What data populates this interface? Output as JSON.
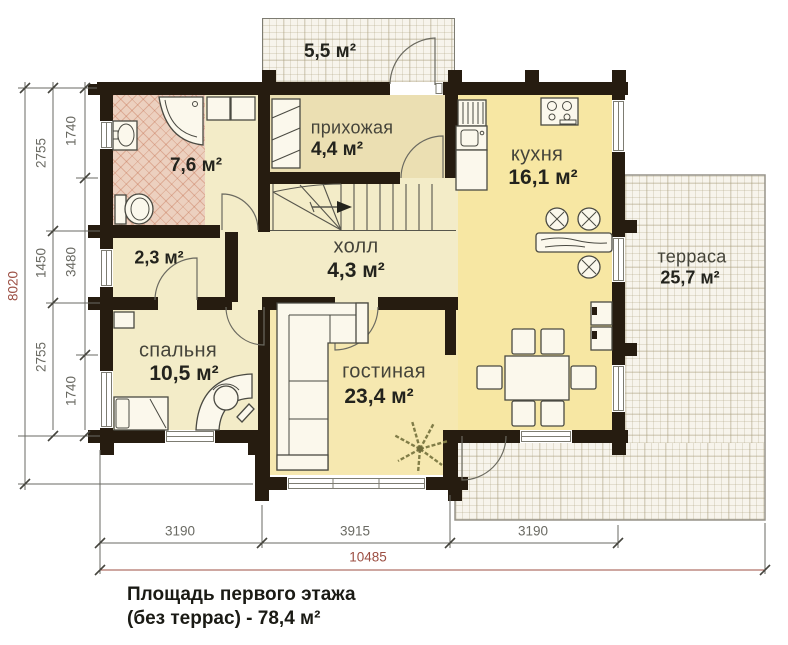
{
  "rooms": {
    "porch": {
      "area": "5,5 м²"
    },
    "bathroom": {
      "area": "7,6 м²"
    },
    "hallway": {
      "name": "прихожая",
      "area": "4,4 м²"
    },
    "kitchen": {
      "name": "кухня",
      "area": "16,1 м²"
    },
    "hall": {
      "name": "холл",
      "area": "4,3 м²"
    },
    "closet": {
      "area": "2,3 м²"
    },
    "bedroom": {
      "name": "спальня",
      "area": "10,5 м²"
    },
    "living": {
      "name": "гостиная",
      "area": "23,4 м²"
    },
    "terrace": {
      "name": "терраса",
      "area": "25,7 м²"
    }
  },
  "dimensions": {
    "left": {
      "overall": "8020",
      "inner": [
        "2755",
        "1450",
        "2755"
      ],
      "innermost": [
        "1740",
        "3480",
        "1740"
      ]
    },
    "bottom": {
      "segments": [
        "3190",
        "3915",
        "3190"
      ],
      "overall": "10485"
    }
  },
  "caption": {
    "line1": "Площадь первого этажа",
    "line2": "(без террас) - 78,4 м²"
  },
  "colors": {
    "wall": "#261c10",
    "cream": "#f3ecc8",
    "tan": "#ebdfb2",
    "yellow": "#f7e7a3",
    "living": "#f6e8b0",
    "tile": "#ecd0bf",
    "deck": "#f7f4ec",
    "dimgray": "#6a6a63",
    "dimred": "#9c4f43",
    "ink": "#23231d",
    "label": "#45443a",
    "furn": "#4a4a42"
  }
}
